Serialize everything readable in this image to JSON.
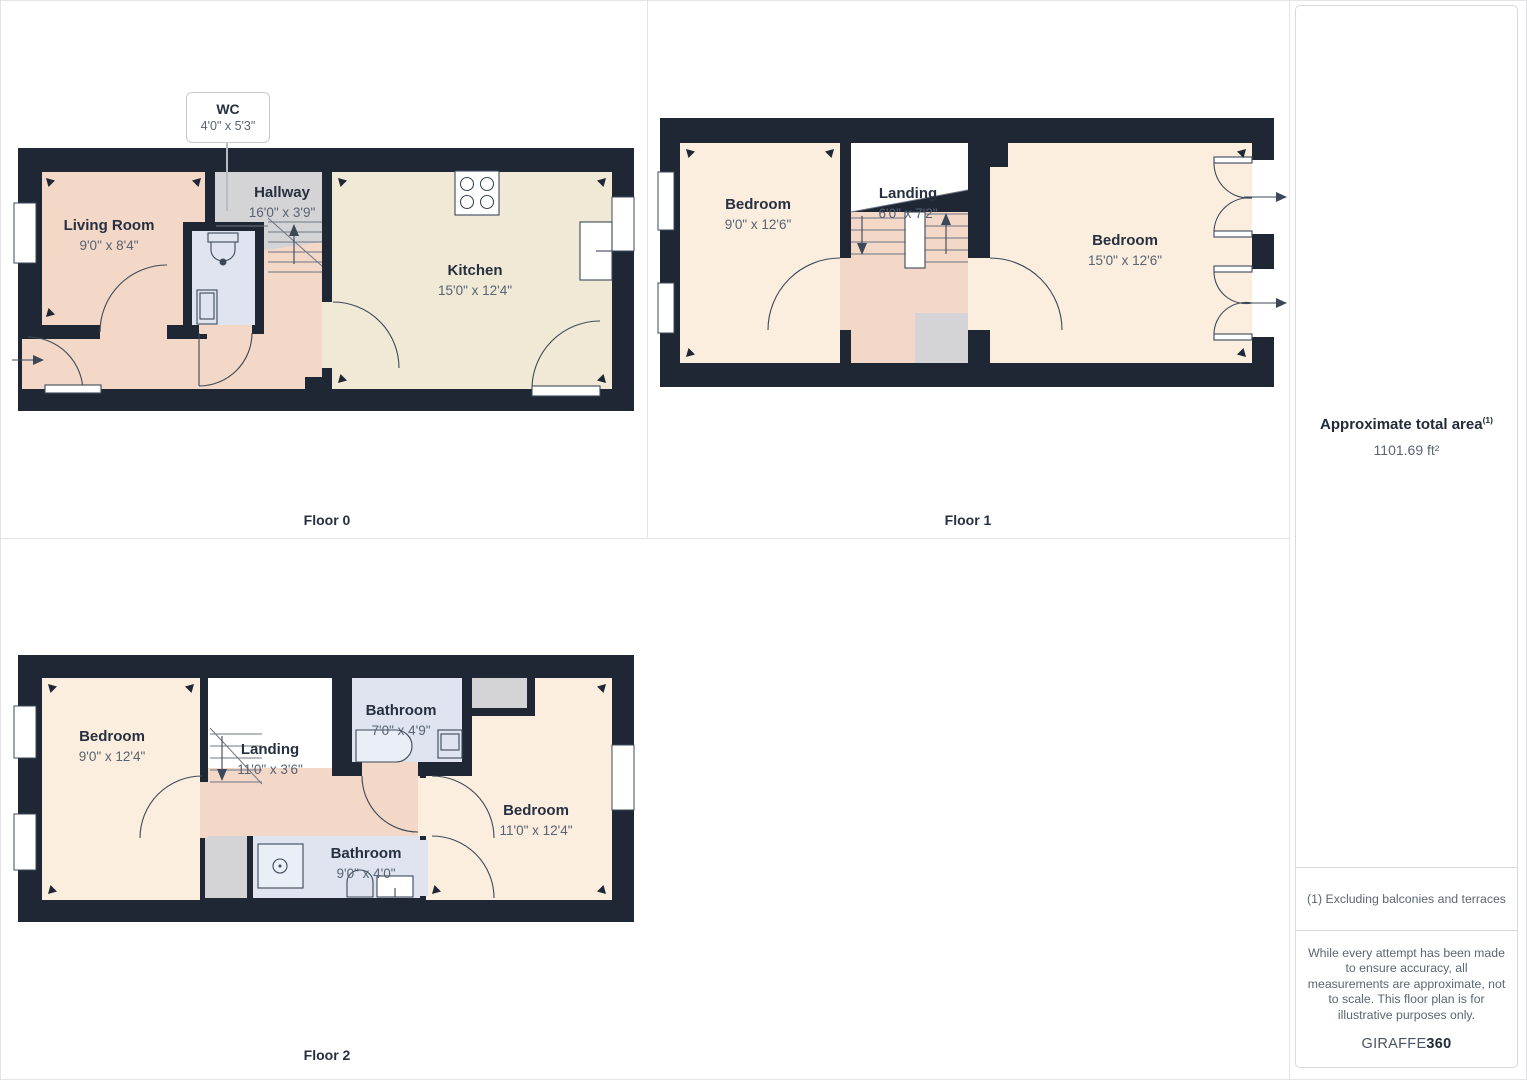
{
  "colors": {
    "wall": "#1e2733",
    "salmon": "#f3d7c7",
    "cream": "#f0e9d6",
    "peach": "#fceede",
    "blue": "#dfe4f0",
    "gray": "#d4d4d6",
    "line": "#3c4858",
    "tread": "#6e7683",
    "label": "#273040",
    "dims": "#576272",
    "muted": "#5b6573",
    "grid": "#e4e4e6",
    "pborder": "#d7d9db"
  },
  "floors": [
    {
      "caption": "Floor 0",
      "rooms": [
        {
          "name": "Living Room",
          "dims": "9'0\" x 8'4\""
        },
        {
          "name": "Hallway",
          "dims": "16'0\" x 3'9\""
        },
        {
          "name": "Kitchen",
          "dims": "15'0\" x 12'4\""
        }
      ],
      "callout": {
        "name": "WC",
        "dims": "4'0\" x 5'3\""
      }
    },
    {
      "caption": "Floor 1",
      "rooms": [
        {
          "name": "Bedroom",
          "dims": "9'0\" x 12'6\""
        },
        {
          "name": "Landing",
          "dims": "6'0\" x 7'2\""
        },
        {
          "name": "Bedroom",
          "dims": "15'0\" x 12'6\""
        }
      ]
    },
    {
      "caption": "Floor 2",
      "rooms": [
        {
          "name": "Bedroom",
          "dims": "9'0\" x 12'4\""
        },
        {
          "name": "Landing",
          "dims": "11'0\" x 3'6\""
        },
        {
          "name": "Bathroom",
          "dims": "7'0\" x 4'9\""
        },
        {
          "name": "Bathroom",
          "dims": "9'0\" x 4'0\""
        },
        {
          "name": "Bedroom",
          "dims": "11'0\" x 12'4\""
        }
      ]
    }
  ],
  "panel": {
    "area_title": "Approximate total area",
    "area_note_ref": "(1)",
    "area_value": "1101.69 ft²",
    "footnote": "(1) Excluding balconies and terraces",
    "disclaimer": "While every attempt has been made to ensure accuracy, all measurements are approximate, not to scale. This floor plan is for illustrative purposes only.",
    "brand_regular": "GIRAFFE",
    "brand_bold": "360"
  }
}
